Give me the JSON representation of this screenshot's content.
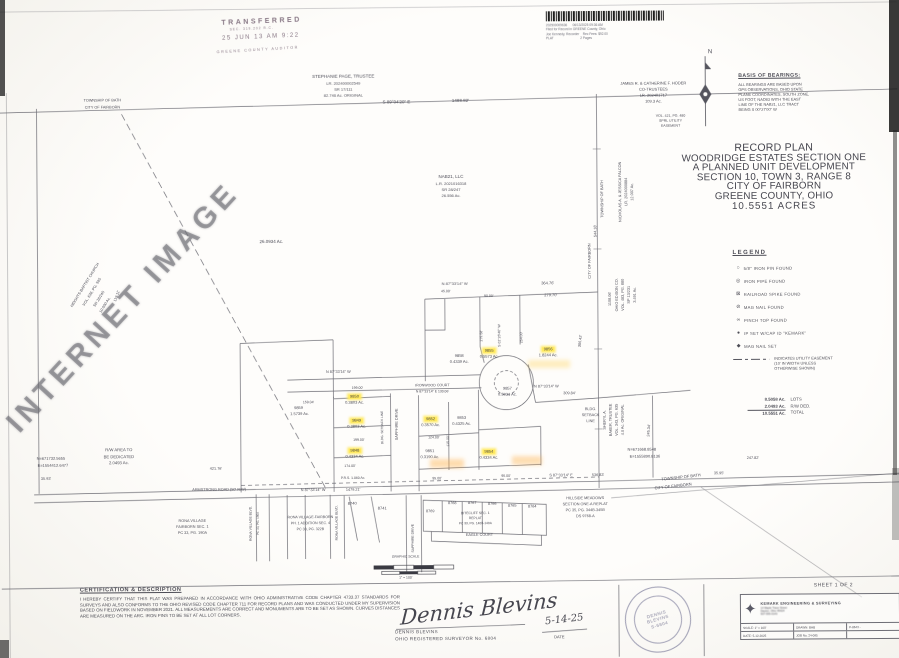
{
  "page": {
    "sheet_note": "SHEET 1 OF 2"
  },
  "colors": {
    "highlight": "#ffe95c",
    "ink": "#3c3c48",
    "stamp": "#746272"
  },
  "watermark": {
    "text": "INTERNET IMAGE"
  },
  "stamps": {
    "transferred": {
      "lines": [
        "TRANSFERRED",
        "SEC. 319.202 R.C.",
        "25 JUN 13  AM 9:22",
        "GREENE COUNTY AUDITOR"
      ]
    },
    "recorder": {
      "lines": [
        "202500009636      06/13/2025 09:36 AM",
        "Filed for Record in GREENE County, Ohio",
        "Joe Kennedy, Recorder    Rec Fees: $92.00",
        "PLAT                              2 Pages"
      ]
    }
  },
  "basis_of_bearings": {
    "title": "BASIS OF BEARINGS:",
    "body_lines": [
      "ALL BEARINGS ARE BASED UPON",
      "GPS OBSERVATIONS, OHIO STATE",
      "PLANE COORDINATES, SOUTH ZONE,",
      "US FOOT, NAD83 WITH THE EAST",
      "LINE OF THE NAB21, LLC TRACT",
      "BEING S 00°27'00\" W"
    ]
  },
  "title_block": {
    "lines": [
      "RECORD PLAN",
      "WOODRIDGE ESTATES SECTION ONE",
      "A PLANNED UNIT DEVELOPMENT",
      "SECTION 10, TOWN 3, RANGE 8",
      "CITY OF FAIRBORN",
      "GREENE COUNTY, OHIO",
      "10.5551 ACRES"
    ]
  },
  "legend": {
    "title": "LEGEND",
    "items": [
      {
        "symbol": "○",
        "icon": "iron-pin-found-icon",
        "label": "5/8\" IRON PIN FOUND"
      },
      {
        "symbol": "◎",
        "icon": "iron-pipe-found-icon",
        "label": "IRON PIPE FOUND"
      },
      {
        "symbol": "⊠",
        "icon": "railroad-spike-found-icon",
        "label": "RAILROAD SPIKE FOUND"
      },
      {
        "symbol": "⊘",
        "icon": "mag-nail-found-icon",
        "label": "MAG NAIL FOUND"
      },
      {
        "symbol": "∞",
        "icon": "pinch-top-found-icon",
        "label": "PINCH TOP FOUND"
      },
      {
        "symbol": "●",
        "icon": "ip-set-icon",
        "label": "IP SET W/CAP ID \"KEMARK\""
      },
      {
        "symbol": "◆",
        "icon": "mag-nail-set-icon",
        "label": "MAG NAIL SET"
      }
    ],
    "easement_lines": [
      "INDICATES UTILITY EASEMENT",
      "(10' IN WIDTH UNLESS",
      "OTHERWISE SHOWN)"
    ],
    "totals": [
      {
        "value": "8.5058 Ac.",
        "label": "LOTS",
        "final": false
      },
      {
        "value": "2.0493 Ac.",
        "label": "R/W DED.",
        "final": false
      },
      {
        "value": "10.5551 Ac.",
        "label": "TOTAL",
        "final": true
      }
    ]
  },
  "certification": {
    "title": "CERTIFICATION & DESCRIPTION",
    "body": "I HEREBY CERTIFY THAT THIS PLAT WAS PREPARED IN ACCORDANCE WITH OHIO ADMINISTRATIVE CODE CHAPTER 4733.37 STANDARDS FOR SURVEYS AND ALSO CONFORMS TO THE OHIO REVISED CODE CHAPTER 711 FOR RECORD PLANS AND WAS CONDUCTED UNDER MY SUPERVISION BASED ON FIELDWORK IN NOVEMBER 2021. ALL MEASUREMENTS ARE CORRECT AND MONUMENTS ARE TO BE SET AS SHOWN. CURVES DISTANCES ARE MEASURED ON THE ARC. IRON PINS TO BE SET AT ALL LOT CORNERS."
  },
  "signature": {
    "script": "Dennis Blevins",
    "name": "DENNIS BLEVINS",
    "title": "OHIO REGISTERED SURVEYOR No. 6804",
    "date": "5-14-25",
    "date_label": "DATE"
  },
  "seal": {
    "center_lines": [
      "DENNIS",
      "BLEVINS",
      "S-6804"
    ]
  },
  "firm": {
    "name": "KEMARK ENGINEERING & SURVEYING",
    "logo": "✦",
    "address_lines": [
      "14 Maple Trace Street",
      "Dayton, Ohio 45424",
      "937-555-0143"
    ],
    "rows": [
      [
        "SCALE: 1\" = 100'",
        "DRAWN: BHB",
        "P-8643 -"
      ],
      [
        "DATE: 5-12-2025",
        "JOB No. 24-085",
        ""
      ]
    ]
  },
  "scale_bar": {
    "title": "GRAPHIC SCALE",
    "note": "1\" = 100'"
  },
  "plat": {
    "labels": [
      {
        "t": "N",
        "x": 712,
        "y": 54,
        "s": 6,
        "n": "north-arrow-label"
      },
      {
        "t": "STEPHANIE PAGE, TRUSTEE",
        "x": 345,
        "y": 76,
        "s": 4.5
      },
      {
        "t": "LR. 202400002549",
        "x": 345,
        "y": 83,
        "s": 4
      },
      {
        "t": "SR 17/111",
        "x": 345,
        "y": 89,
        "s": 4
      },
      {
        "t": "82.746 Ac. ORIGINAL",
        "x": 345,
        "y": 95,
        "s": 4
      },
      {
        "t": "S 89°04'20\" E",
        "x": 398,
        "y": 102,
        "s": 4.5
      },
      {
        "t": "1488.82'",
        "x": 462,
        "y": 101,
        "s": 4.5
      },
      {
        "t": "TOWNSHIP OF BATH",
        "x": 104,
        "y": 99,
        "s": 3.8
      },
      {
        "t": "CITY OF FAIRBORN",
        "x": 104,
        "y": 106,
        "s": 3.8
      },
      {
        "t": "JAMES R. & CATHERINE F. HODER",
        "x": 655,
        "y": 85,
        "s": 4
      },
      {
        "t": "CO-TRUSTEES",
        "x": 655,
        "y": 91,
        "s": 4
      },
      {
        "t": "LR. 202401717",
        "x": 655,
        "y": 97,
        "s": 4
      },
      {
        "t": "109.3 Ac.",
        "x": 655,
        "y": 103,
        "s": 4
      },
      {
        "t": "VOL. 421, PG. 480",
        "x": 672,
        "y": 118,
        "s": 3.5
      },
      {
        "t": "SPRL UTILITY",
        "x": 672,
        "y": 123,
        "s": 3.5
      },
      {
        "t": "EASEMENT",
        "x": 672,
        "y": 128,
        "s": 3.5
      },
      {
        "t": "NAB21, LLC",
        "x": 452,
        "y": 177,
        "s": 4.5
      },
      {
        "t": "L.R. 2021016318",
        "x": 452,
        "y": 184,
        "s": 4
      },
      {
        "t": "SR 28/247",
        "x": 452,
        "y": 190,
        "s": 4
      },
      {
        "t": "26.556 Ac.",
        "x": 452,
        "y": 196,
        "s": 4
      },
      {
        "t": "26.0934 Ac.",
        "x": 272,
        "y": 241,
        "s": 4.5
      },
      {
        "t": "NICHOLAS A. & JESSICA FALCON",
        "x": 622,
        "y": 193,
        "r": -90,
        "s": 3.8
      },
      {
        "t": "LR. 2024000884",
        "x": 628,
        "y": 193,
        "r": -90,
        "s": 3.8
      },
      {
        "t": "12.007 Ac.",
        "x": 634,
        "y": 193,
        "r": -90,
        "s": 3.8
      },
      {
        "t": "TOWNSHIP OF BATH",
        "x": 604,
        "y": 200,
        "r": -90,
        "s": 3.8
      },
      {
        "t": "CITY OF FAIRBORN",
        "x": 591,
        "y": 262,
        "r": -90,
        "s": 3.8
      },
      {
        "t": "544.18'",
        "x": 597,
        "y": 232,
        "r": -90,
        "s": 3.8
      },
      {
        "t": "1108.06'",
        "x": 611,
        "y": 300,
        "r": -90,
        "s": 3.8
      },
      {
        "t": "OHIO EDISON CO.",
        "x": 618,
        "y": 296,
        "r": -90,
        "s": 3.8
      },
      {
        "t": "VOL. 483, PG. 880",
        "x": 624,
        "y": 296,
        "r": -90,
        "s": 3.8
      },
      {
        "t": "SP 13/231",
        "x": 630,
        "y": 296,
        "r": -90,
        "s": 3.8
      },
      {
        "t": "3.491 Ac.",
        "x": 636,
        "y": 296,
        "r": -90,
        "s": 3.8
      },
      {
        "t": "HEIGHTS BAPTIST CHURCH",
        "x": 86,
        "y": 283,
        "r": -58,
        "s": 3.8
      },
      {
        "t": "VOL. 638, PG. 595",
        "x": 93,
        "y": 290,
        "r": -58,
        "s": 3.8
      },
      {
        "t": "SR 28/245",
        "x": 100,
        "y": 297,
        "r": -58,
        "s": 3.8
      },
      {
        "t": "10.000 Ac.",
        "x": 106,
        "y": 303,
        "r": -58,
        "s": 3.8
      },
      {
        "t": "119.11'",
        "x": 118,
        "y": 294,
        "r": -70,
        "s": 3.8
      },
      {
        "t": "N 87°33'14\" W",
        "x": 455,
        "y": 284,
        "s": 4
      },
      {
        "t": "364.76'",
        "x": 548,
        "y": 284,
        "s": 4
      },
      {
        "t": "279.70'",
        "x": 551,
        "y": 296,
        "s": 4
      },
      {
        "t": "90.00'",
        "x": 489,
        "y": 297,
        "s": 3.5
      },
      {
        "t": "45.00'",
        "x": 446,
        "y": 292,
        "s": 3.5
      },
      {
        "t": "S 02°26'46\" W",
        "x": 500,
        "y": 336,
        "r": -90,
        "s": 3.5
      },
      {
        "t": "254.00'",
        "x": 522,
        "y": 338,
        "r": -90,
        "s": 3.5
      },
      {
        "t": "279.58'",
        "x": 482,
        "y": 336,
        "r": -90,
        "s": 3.5
      },
      {
        "t": "306.42'",
        "x": 581,
        "y": 342,
        "r": -83,
        "s": 3.8
      },
      {
        "t": "9858",
        "x": 459,
        "y": 356,
        "s": 4
      },
      {
        "t": "0.4339 Ac.",
        "x": 459,
        "y": 362,
        "s": 4
      },
      {
        "t": "9855",
        "x": 489,
        "y": 351,
        "s": 4,
        "c": "hl"
      },
      {
        "t": "0.5573 Ac.",
        "x": 489,
        "y": 357,
        "s": 4
      },
      {
        "t": "9856",
        "x": 548,
        "y": 350,
        "s": 4,
        "c": "hl"
      },
      {
        "t": "1.8244 Ac.",
        "x": 548,
        "y": 356,
        "s": 4
      },
      {
        "t": "9857",
        "x": 507,
        "y": 389,
        "s": 4
      },
      {
        "t": "0.5031 Ac.",
        "x": 507,
        "y": 395,
        "s": 4
      },
      {
        "t": "N 87°33'14\" W",
        "x": 546,
        "y": 388,
        "s": 3.8
      },
      {
        "t": "309.84'",
        "x": 569,
        "y": 395,
        "s": 3.8
      },
      {
        "t": "BLDG.",
        "x": 590,
        "y": 411,
        "s": 3.8
      },
      {
        "t": "SETBACK",
        "x": 590,
        "y": 417,
        "s": 3.8
      },
      {
        "t": "LINE",
        "x": 590,
        "y": 423,
        "s": 3.8
      },
      {
        "t": "245.34'",
        "x": 649,
        "y": 432,
        "r": -85,
        "s": 3.8
      },
      {
        "t": "SHERYL A.",
        "x": 605,
        "y": 421,
        "r": -90,
        "s": 3.8
      },
      {
        "t": "BAKER, TRUSTEE",
        "x": 611,
        "y": 421,
        "r": -90,
        "s": 3.8
      },
      {
        "t": "VOL. 343, PG. 635",
        "x": 617,
        "y": 421,
        "r": -90,
        "s": 3.8
      },
      {
        "t": "4.0 Ac. ORIGINAL",
        "x": 623,
        "y": 421,
        "r": -90,
        "s": 3.8
      },
      {
        "t": "N 87°33'14\" W",
        "x": 338,
        "y": 372,
        "s": 3.8
      },
      {
        "t": "159.04'",
        "x": 308,
        "y": 402,
        "s": 3.5
      },
      {
        "t": "199.00'",
        "x": 357,
        "y": 388,
        "s": 3.5
      },
      {
        "t": "9859",
        "x": 298,
        "y": 407,
        "s": 4
      },
      {
        "t": "1.5739 Ac.",
        "x": 299,
        "y": 413,
        "s": 4
      },
      {
        "t": "9850",
        "x": 354,
        "y": 396,
        "s": 4,
        "c": "hl"
      },
      {
        "t": "0.3803 Ac.",
        "x": 354,
        "y": 402,
        "s": 4
      },
      {
        "t": "9849",
        "x": 356,
        "y": 420,
        "s": 4,
        "c": "hl"
      },
      {
        "t": "0.3803 Ac.",
        "x": 356,
        "y": 426,
        "s": 4
      },
      {
        "t": "199.00'",
        "x": 358,
        "y": 440,
        "s": 3.5
      },
      {
        "t": "9848",
        "x": 354,
        "y": 450,
        "s": 4,
        "c": "hl"
      },
      {
        "t": "0.4334 Ac.",
        "x": 354,
        "y": 456,
        "s": 4
      },
      {
        "t": "174.00'",
        "x": 349,
        "y": 466,
        "s": 3.5
      },
      {
        "t": "BLDG. SETBACK LINE",
        "x": 382,
        "y": 427,
        "r": -90,
        "s": 3.2
      },
      {
        "t": "SAPPHIRE DRIVE",
        "x": 397,
        "y": 424,
        "r": -90,
        "s": 3.8
      },
      {
        "t": "IRONWOOD COURT",
        "x": 432,
        "y": 386,
        "s": 3.6
      },
      {
        "t": "N 87°33'14\" E   130.06'",
        "x": 432,
        "y": 392,
        "s": 3.4
      },
      {
        "t": "9852",
        "x": 430,
        "y": 419,
        "s": 4,
        "c": "hl"
      },
      {
        "t": "0.3570 Ac.",
        "x": 430,
        "y": 425,
        "s": 4
      },
      {
        "t": "124.00'",
        "x": 433,
        "y": 438,
        "s": 3.5
      },
      {
        "t": "9851",
        "x": 429,
        "y": 451,
        "s": 4
      },
      {
        "t": "0.3190 Ac.",
        "x": 429,
        "y": 457,
        "s": 4
      },
      {
        "t": "115.00'",
        "x": 448,
        "y": 441,
        "r": -90,
        "s": 3.5
      },
      {
        "t": "9853",
        "x": 461,
        "y": 418,
        "s": 4
      },
      {
        "t": "0.4325 Ac.",
        "x": 461,
        "y": 424,
        "s": 4
      },
      {
        "t": "9854",
        "x": 488,
        "y": 452,
        "s": 4,
        "c": "hl"
      },
      {
        "t": "0.4334 Ac.",
        "x": 488,
        "y": 458,
        "s": 4
      },
      {
        "t": "95.00'",
        "x": 436,
        "y": 479,
        "s": 3.5
      },
      {
        "t": "95.00'",
        "x": 505,
        "y": 477,
        "s": 3.5
      },
      {
        "t": "P.R.S. 1.060 Ac.",
        "x": 352,
        "y": 478,
        "s": 3.4
      },
      {
        "t": "N=671732.5655",
        "x": 50,
        "y": 456,
        "s": 4
      },
      {
        "t": "E=1554412.6477",
        "x": 52,
        "y": 463,
        "s": 4
      },
      {
        "t": "R/W AREA TO",
        "x": 118,
        "y": 448,
        "s": 4.2
      },
      {
        "t": "BE DEDICATED",
        "x": 118,
        "y": 454.5,
        "s": 4.2
      },
      {
        "t": "2.0493 Ac.",
        "x": 118,
        "y": 461,
        "s": 4.2
      },
      {
        "t": "35.93'",
        "x": 45,
        "y": 477,
        "s": 3.8
      },
      {
        "t": "421.76'",
        "x": 215,
        "y": 468,
        "s": 3.8
      },
      {
        "t": "ARMSTRONG ROAD (50' R/W)",
        "x": 218,
        "y": 489,
        "s": 3.8
      },
      {
        "t": "N 87°33'14\" W",
        "x": 312,
        "y": 490,
        "s": 3.8
      },
      {
        "t": "1479.21'",
        "x": 352,
        "y": 490,
        "s": 3.8
      },
      {
        "t": "S 87°33'14\" E",
        "x": 560,
        "y": 477,
        "s": 3.8
      },
      {
        "t": "536.83'",
        "x": 597,
        "y": 477,
        "s": 3.8
      },
      {
        "t": "35.95'",
        "x": 718,
        "y": 476,
        "s": 3.8
      },
      {
        "t": "247.82'",
        "x": 752,
        "y": 461,
        "s": 3.8
      },
      {
        "t": "N=671668.8548",
        "x": 641,
        "y": 451,
        "s": 4
      },
      {
        "t": "E=1555890.8136",
        "x": 644,
        "y": 458,
        "s": 4
      },
      {
        "t": "TOWNSHIP OF BATH",
        "x": 680,
        "y": 479,
        "r": -6,
        "s": 4
      },
      {
        "t": "CITY OF FAIRBORN",
        "x": 672,
        "y": 488,
        "r": -6,
        "s": 4
      },
      {
        "t": "RONA VILLAGE",
        "x": 191,
        "y": 520,
        "s": 3.8
      },
      {
        "t": "FAIRBORN SEC. 1",
        "x": 191,
        "y": 526,
        "s": 3.8
      },
      {
        "t": "PC 33, PG. 190A",
        "x": 191,
        "y": 532,
        "s": 3.8
      },
      {
        "t": "RONA VILLAGE BLVD.",
        "x": 250,
        "y": 522,
        "r": -90,
        "s": 3.4
      },
      {
        "t": "PC 33, PG. 190A",
        "x": 257,
        "y": 522,
        "r": -90,
        "s": 3
      },
      {
        "t": "RONA VILLAGE-FAIRBORN",
        "x": 309,
        "y": 517,
        "s": 3.6
      },
      {
        "t": "PH. 1 ADDITION SEC. 4",
        "x": 309,
        "y": 523,
        "s": 3.6
      },
      {
        "t": "PC 33, PG. 322B",
        "x": 309,
        "y": 529,
        "s": 3.6
      },
      {
        "t": "RONA VILLAGE BLVD.",
        "x": 336,
        "y": 522,
        "r": -90,
        "s": 3.4
      },
      {
        "t": "8740",
        "x": 351,
        "y": 503,
        "s": 4
      },
      {
        "t": "8741",
        "x": 381,
        "y": 508,
        "s": 4
      },
      {
        "t": "SAPPHIRE DRIVE",
        "x": 412,
        "y": 538,
        "r": -90,
        "s": 3.4
      },
      {
        "t": "8769",
        "x": 429,
        "y": 512,
        "s": 3.8
      },
      {
        "t": "8768",
        "x": 451,
        "y": 504,
        "s": 3.8
      },
      {
        "t": "8767",
        "x": 471,
        "y": 504,
        "s": 3.8
      },
      {
        "t": "8766",
        "x": 491,
        "y": 505,
        "s": 3.8
      },
      {
        "t": "8765",
        "x": 511,
        "y": 507,
        "s": 3.8
      },
      {
        "t": "8764",
        "x": 531,
        "y": 508,
        "s": 3.8
      },
      {
        "t": "BITECLIFF SEC. 1",
        "x": 474,
        "y": 514,
        "s": 3.4
      },
      {
        "t": "REPLAT",
        "x": 474,
        "y": 519,
        "s": 3.4
      },
      {
        "t": "PC 33, PG. 140B-140A",
        "x": 474,
        "y": 524,
        "s": 3.2
      },
      {
        "t": "EAGLE COURT",
        "x": 478,
        "y": 536,
        "s": 3.8
      },
      {
        "t": "HILLSIDE MEADOWS",
        "x": 584,
        "y": 500,
        "s": 3.8
      },
      {
        "t": "SECTION ONE-A REPLAT",
        "x": 584,
        "y": 506,
        "s": 3.8
      },
      {
        "t": "PC 35, PG. 344B-345B",
        "x": 584,
        "y": 512,
        "s": 3.8
      },
      {
        "t": "DS 9768-A",
        "x": 584,
        "y": 518,
        "s": 3.8
      },
      {
        "t": "GRAPHIC SCALE",
        "x": 404,
        "y": 557,
        "s": 3.4
      },
      {
        "t": "1\" = 100'",
        "x": 404,
        "y": 578,
        "s": 3.4
      }
    ]
  }
}
